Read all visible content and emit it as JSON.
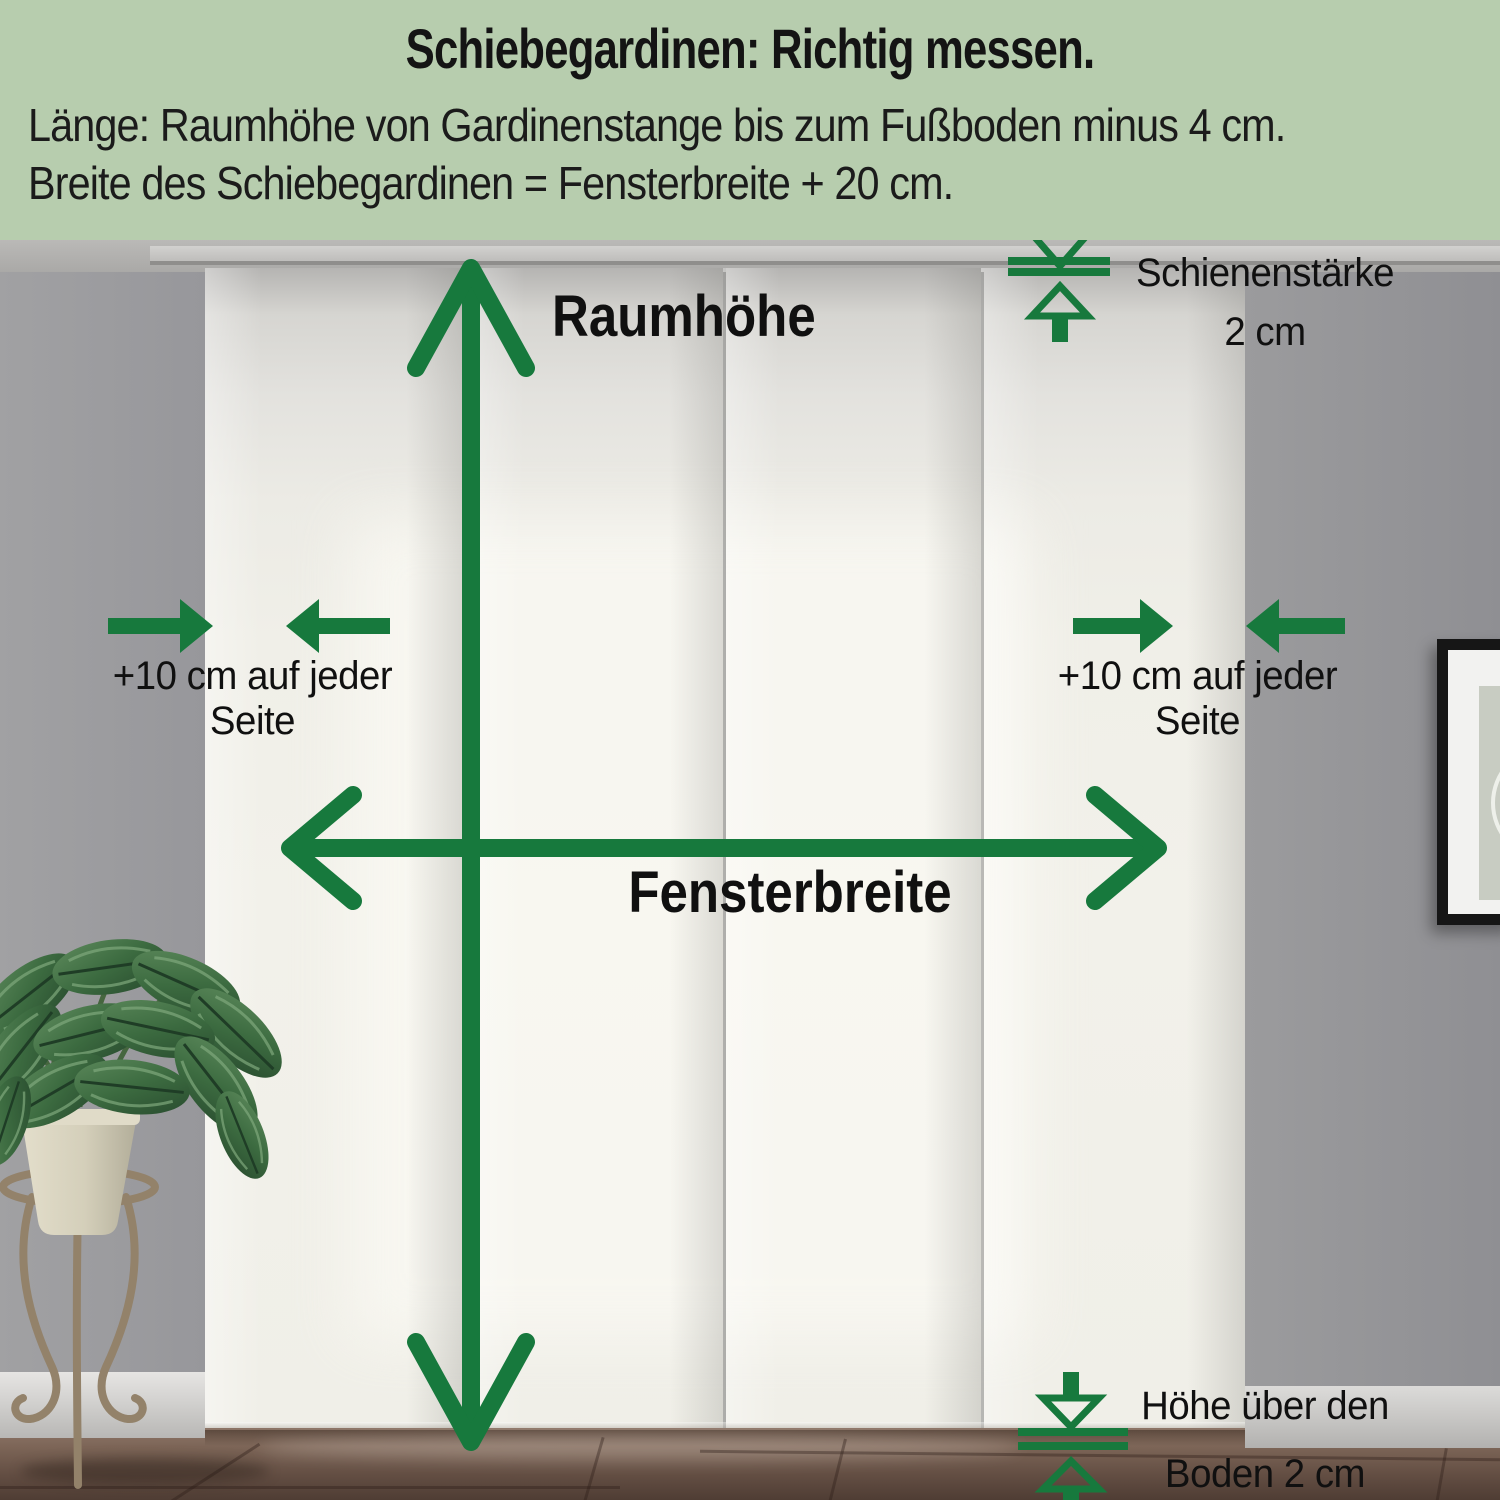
{
  "header": {
    "title": "Schiebegardinen: Richtig messen.",
    "line1": "Länge: Raumhöhe von Gardinenstange bis zum Fußboden minus 4 cm.",
    "line2": "Breite des Schiebegardinen = Fensterbreite + 20 cm."
  },
  "annotations": {
    "room_height": "Raumhöhe",
    "window_width": "Fensterbreite",
    "rail_thickness_line1": "Schienenstärke",
    "rail_thickness_line2": "2 cm",
    "side_left_line1": "+10 cm auf jeder",
    "side_left_line2": "Seite",
    "side_right_line1": "+10 cm auf jeder",
    "side_right_line2": "Seite",
    "floor_gap_line1": "Höhe über den",
    "floor_gap_line2": "Boden 2 cm"
  },
  "colors": {
    "accent_green": "#17793d",
    "header_background": "#b7cdae",
    "text_black": "#141414",
    "curtain_white": "#f2f1ea",
    "wall_gray": "#9c9c9e",
    "floor_brown": "#6b564a"
  },
  "icons": {
    "vertical_measure": "double-arrow-vertical-icon",
    "horizontal_measure": "double-arrow-horizontal-icon",
    "side_left": "converging-arrows-icon",
    "side_right": "converging-arrows-icon",
    "rail_thickness": "thickness-gauge-icon",
    "floor_gap": "thickness-gauge-icon"
  }
}
